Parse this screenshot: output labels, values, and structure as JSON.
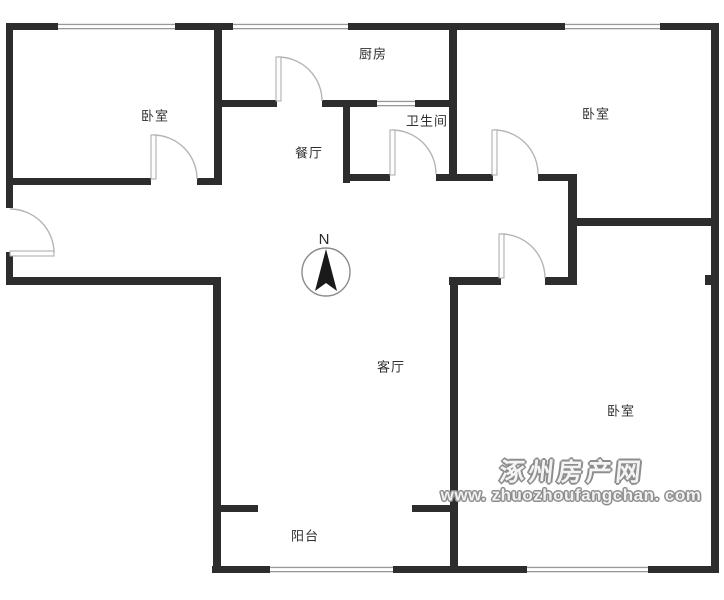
{
  "floorplan": {
    "colors": {
      "background": "#ffffff",
      "wall": "#2d2d2d",
      "door_leaf_fill": "#fdfdfd",
      "door_leaf_stroke": "#a8a8a8",
      "door_arc": "#b5b5b5",
      "window_line": "#999999",
      "label_text": "#2f2f2f",
      "compass_needle": "#1a1a1a",
      "compass_ring": "#8c8c8c",
      "watermark_gray": "#8d8d8d"
    },
    "rooms": [
      {
        "id": "bedroom-left",
        "label": "卧室",
        "x": 155,
        "y": 116
      },
      {
        "id": "kitchen",
        "label": "厨房",
        "x": 373,
        "y": 54
      },
      {
        "id": "bathroom",
        "label": "卫生间",
        "x": 427,
        "y": 121
      },
      {
        "id": "dining",
        "label": "餐厅",
        "x": 309,
        "y": 153
      },
      {
        "id": "bedroom-top-right",
        "label": "卧室",
        "x": 596,
        "y": 114
      },
      {
        "id": "living",
        "label": "客厅",
        "x": 391,
        "y": 367
      },
      {
        "id": "bedroom-bottom-right",
        "label": "卧室",
        "x": 621,
        "y": 411
      },
      {
        "id": "balcony",
        "label": "阳台",
        "x": 305,
        "y": 536
      }
    ],
    "compass": {
      "label": "N",
      "cx": 326,
      "cy": 272,
      "r": 24
    },
    "watermark": {
      "line1": "涿州房产网",
      "line2": "www. zhuozhoufangchan. com"
    },
    "walls": [
      [
        6,
        23,
        52,
        7
      ],
      [
        175,
        23,
        58,
        7
      ],
      [
        348,
        23,
        217,
        7
      ],
      [
        660,
        23,
        59,
        7
      ],
      [
        711,
        23,
        8,
        550
      ],
      [
        212,
        566,
        58,
        7
      ],
      [
        393,
        566,
        134,
        7
      ],
      [
        648,
        566,
        70,
        7
      ],
      [
        6,
        23,
        7,
        185
      ],
      [
        6,
        252,
        7,
        33
      ],
      [
        6,
        277,
        213,
        8
      ],
      [
        8,
        178,
        143,
        7
      ],
      [
        197,
        178,
        25,
        7
      ],
      [
        214,
        28,
        8,
        157
      ],
      [
        214,
        100,
        63,
        7
      ],
      [
        322,
        100,
        55,
        7
      ],
      [
        415,
        100,
        34,
        7
      ],
      [
        343,
        100,
        7,
        83
      ],
      [
        449,
        28,
        8,
        153
      ],
      [
        343,
        174,
        47,
        7
      ],
      [
        436,
        174,
        57,
        7
      ],
      [
        538,
        174,
        39,
        7
      ],
      [
        568,
        174,
        9,
        109
      ],
      [
        568,
        218,
        150,
        8
      ],
      [
        449,
        277,
        52,
        8
      ],
      [
        545,
        277,
        32,
        8
      ],
      [
        213,
        277,
        8,
        296
      ],
      [
        450,
        277,
        8,
        289
      ],
      [
        214,
        505,
        44,
        7
      ],
      [
        412,
        505,
        45,
        7
      ],
      [
        705,
        275,
        7,
        10
      ]
    ],
    "windows": [
      {
        "id": "window-top-left",
        "rect": [
          58,
          23,
          117,
          7
        ]
      },
      {
        "id": "window-top-kitchen",
        "rect": [
          233,
          23,
          115,
          7
        ]
      },
      {
        "id": "window-top-right",
        "rect": [
          565,
          23,
          95,
          7
        ]
      },
      {
        "id": "window-bathroom",
        "rect": [
          377,
          100,
          38,
          7
        ]
      },
      {
        "id": "window-balcony",
        "rect": [
          270,
          566,
          123,
          7
        ]
      },
      {
        "id": "window-bottom-right",
        "rect": [
          527,
          566,
          121,
          7
        ]
      }
    ],
    "doors": [
      {
        "id": "door-bedroom-left",
        "leaf": [
          151,
          135,
          5,
          44
        ],
        "arc": "M 153 135 A 44 44 0 0 1 197 179"
      },
      {
        "id": "door-entry",
        "leaf": [
          10,
          251,
          44,
          5
        ],
        "arc": "M 10 209 A 44 44 0 0 1 54 253"
      },
      {
        "id": "door-kitchen",
        "leaf": [
          276,
          57,
          5,
          44
        ],
        "arc": "M 278 57 A 44 44 0 0 1 322 101"
      },
      {
        "id": "door-bathroom",
        "leaf": [
          390,
          130,
          5,
          45
        ],
        "arc": "M 392 130 A 44 44 0 0 1 436 174"
      },
      {
        "id": "door-bedroom-top-right",
        "leaf": [
          492,
          130,
          5,
          45
        ],
        "arc": "M 494 130 A 44 44 0 0 1 538 174"
      },
      {
        "id": "door-bedroom-bottom-right",
        "leaf": [
          499,
          234,
          5,
          44
        ],
        "arc": "M 501 234 A 44 44 0 0 1 545 278"
      }
    ]
  }
}
